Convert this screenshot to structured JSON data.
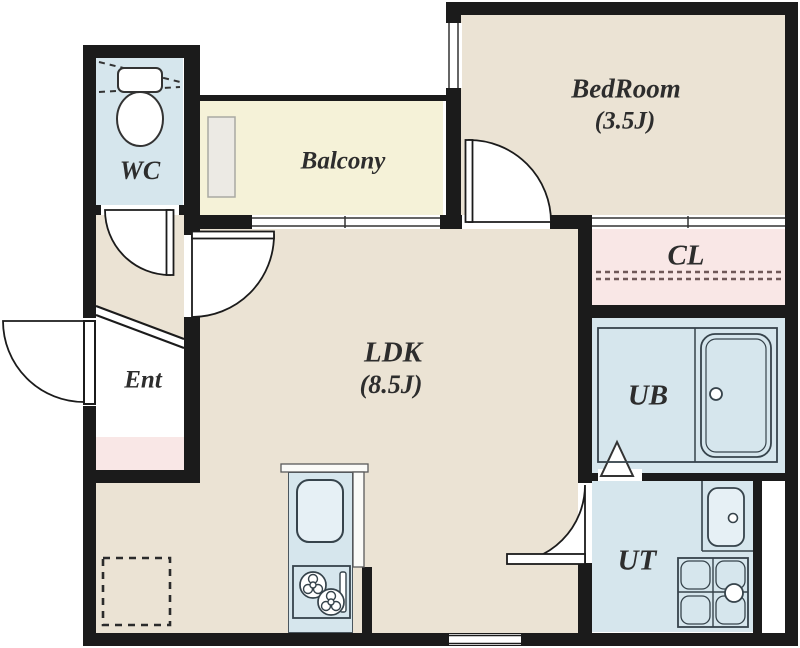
{
  "rooms": {
    "wc": {
      "label": "WC"
    },
    "balcony": {
      "label": "Balcony"
    },
    "bedroom": {
      "label": "BedRoom",
      "size": "(3.5J)"
    },
    "closet": {
      "label": "CL"
    },
    "ldk": {
      "label": "LDK",
      "size": "(8.5J)"
    },
    "entrance": {
      "label": "Ent"
    },
    "unit_bath": {
      "label": "UB"
    },
    "utility": {
      "label": "UT"
    }
  },
  "colors": {
    "wall": "#1b1b1b",
    "floor_beige": "#ebe3d4",
    "balcony_yellow": "#f5f2d8",
    "wet_area_blue": "#d6e6ed",
    "closet_pink": "#f9e7e6",
    "background": "#ffffff"
  },
  "fixtures": [
    "toilet-icon",
    "bathtub-icon",
    "washbasin-icon",
    "washing-machine-pan-icon",
    "kitchen-sink-icon",
    "gas-stove-icon",
    "refrigerator-space-icon",
    "storage-panel-icon"
  ]
}
